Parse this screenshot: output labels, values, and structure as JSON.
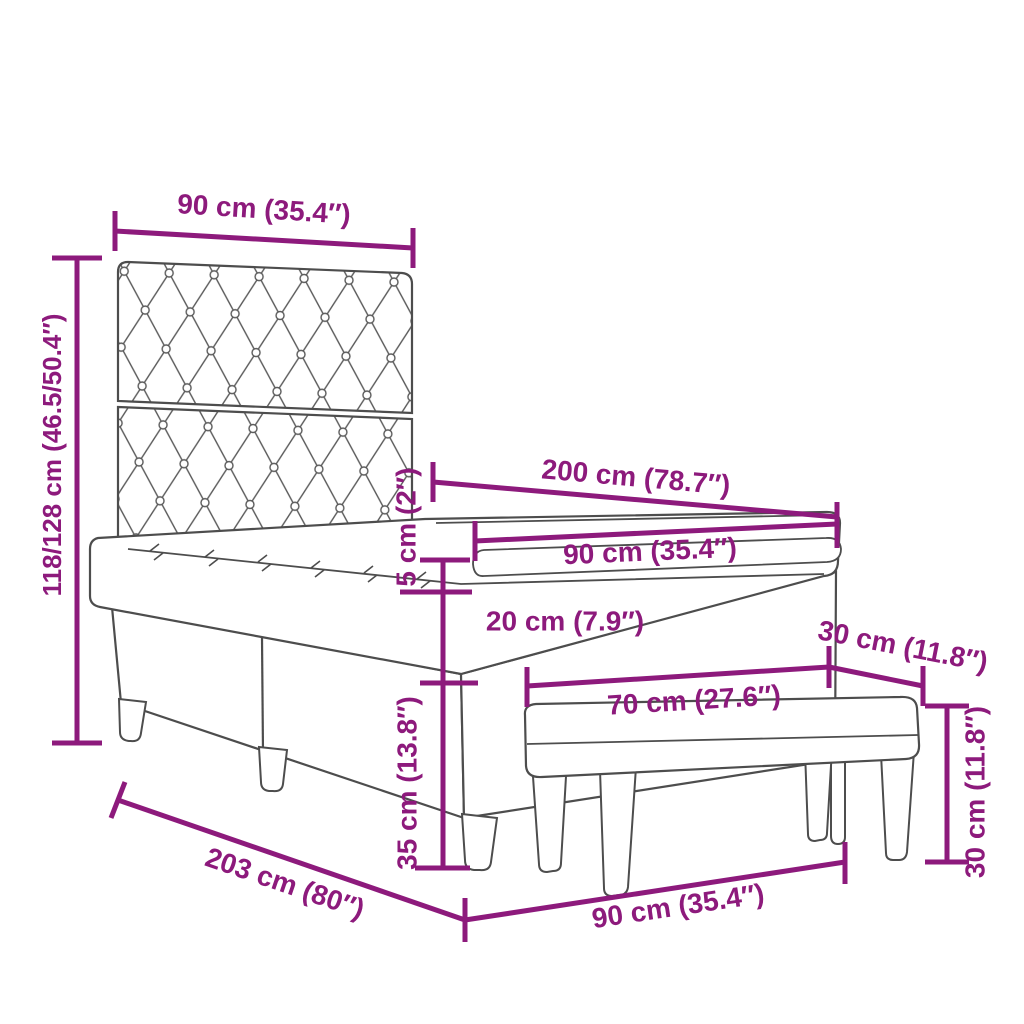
{
  "diagram": {
    "subject": "box-spring-bed-with-headboard-and-bench-dimension-diagram",
    "accent_color": "#8d1a7c",
    "outline_color": "#4d4d4d",
    "dimensions": {
      "headboard_width": "90 cm (35.4″)",
      "height_range": "118/128 cm (46.5/50.4″)",
      "bed_length": "200 cm (78.7″)",
      "mattress_width": "90 cm (35.4″)",
      "topper_thickness": "5 cm (2″)",
      "mattress_thickness": "20 cm (7.9″)",
      "bench_depth": "30 cm (11.8″)",
      "bench_width": "70 cm (27.6″)",
      "base_height": "35 cm (13.8″)",
      "bench_height": "30 cm (11.8″)",
      "frame_length": "203 cm (80″)",
      "bed_width": "90 cm (35.4″)"
    }
  }
}
